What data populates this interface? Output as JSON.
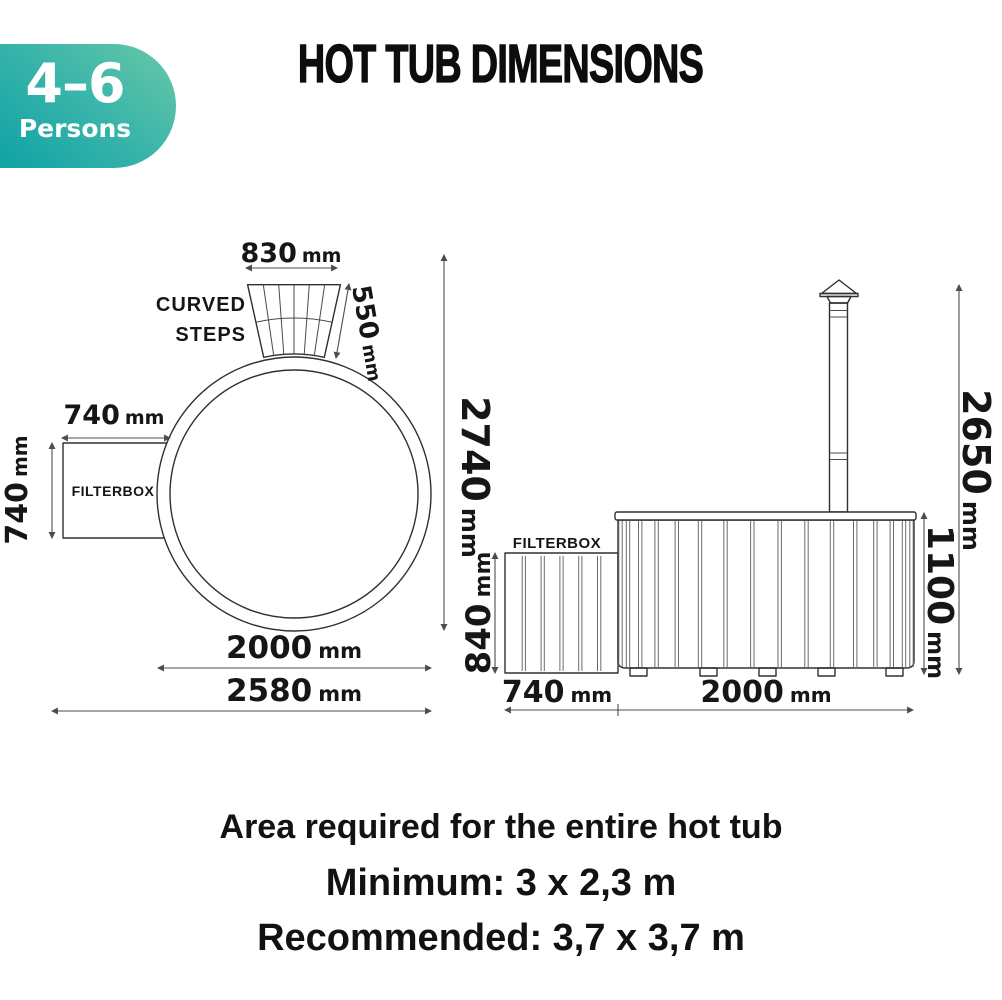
{
  "badge": {
    "range": "4–6",
    "label": "Persons"
  },
  "title": {
    "text": "HOT TUB DIMENSIONS"
  },
  "top_view": {
    "labels": {
      "steps_line1": "CURVED",
      "steps_line2": "STEPS",
      "filterbox": "FILTERBOX"
    },
    "dims": {
      "steps_width": {
        "v": "830",
        "u": "mm"
      },
      "steps_depth": {
        "v": "550",
        "u": "mm"
      },
      "filterbox_width": {
        "v": "740",
        "u": "mm"
      },
      "filterbox_depth": {
        "v": "740",
        "u": "mm"
      },
      "overall_length": {
        "v": "2740",
        "u": "mm"
      },
      "tub_diameter": {
        "v": "2000",
        "u": "mm"
      },
      "overall_width": {
        "v": "2580",
        "u": "mm"
      }
    }
  },
  "side_view": {
    "labels": {
      "filterbox": "FILTERBOX"
    },
    "dims": {
      "filterbox_height": {
        "v": "840",
        "u": "mm"
      },
      "filterbox_width": {
        "v": "740",
        "u": "mm"
      },
      "tub_width": {
        "v": "2000",
        "u": "mm"
      },
      "tub_height": {
        "v": "1100",
        "u": "mm"
      },
      "overall_height": {
        "v": "2650",
        "u": "mm"
      }
    }
  },
  "footer": {
    "line1": "Area required for the entire hot tub",
    "line2": "Minimum: 3 x 2,3 m",
    "line3": "Recommended: 3,7 x 3,7 m"
  },
  "colors": {
    "badge_gradient_start": "#0fa2a6",
    "badge_gradient_end": "#6ac8a6",
    "line": "#303030",
    "dim_line": "#4d4d4d",
    "text": "#161616"
  }
}
